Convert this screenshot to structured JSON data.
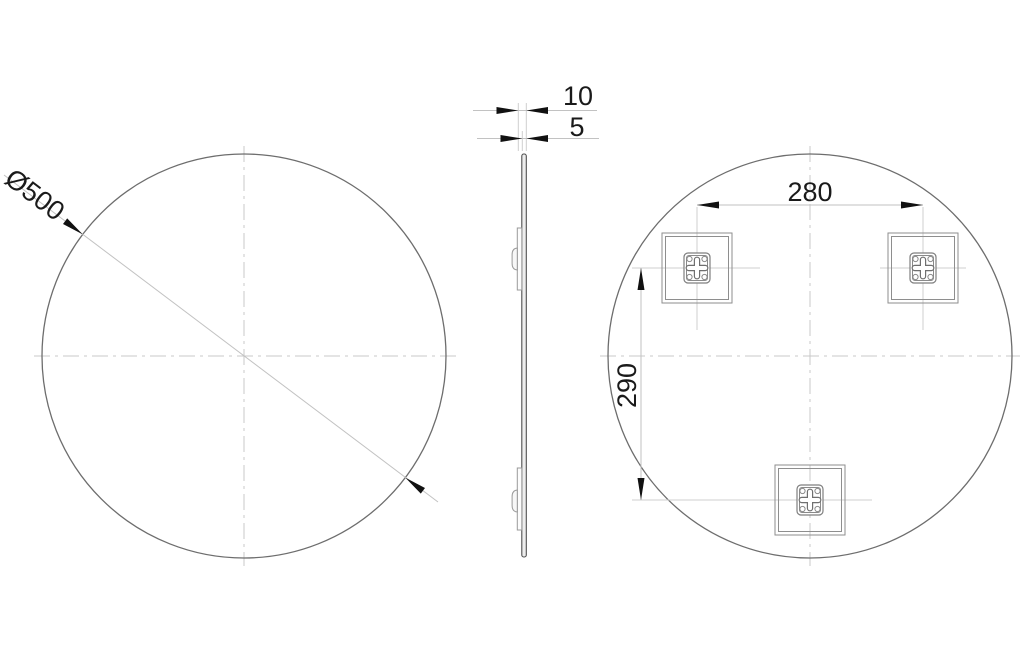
{
  "front_view": {
    "diameter_label": "Ø500"
  },
  "side_view": {
    "total_depth_label": "10",
    "glass_depth_label": "5"
  },
  "back_view": {
    "horizontal_spacing_label": "280",
    "vertical_spacing_label": "290"
  },
  "colors": {
    "background": "#ffffff",
    "object_line": "#6d6d6d",
    "dimension_line": "#c2c2c2",
    "centerline": "#c9c9c9",
    "arrow_and_text": "#1a1a1a"
  }
}
